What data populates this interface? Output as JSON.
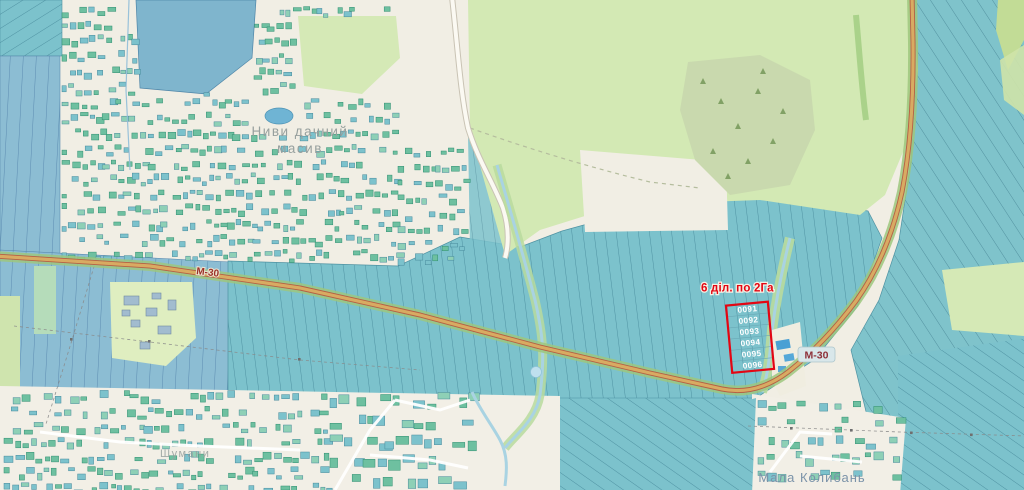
{
  "map": {
    "place_labels": {
      "massif_line1": "Ниви дачний",
      "massif_line2": "масив",
      "village_sw": "Шумани",
      "village_se": "Мала Колибань"
    },
    "road_labels": {
      "west": "М-30",
      "east": "М-30"
    },
    "annotation": {
      "title": "6 діл. по 2Га",
      "parcel_numbers": [
        "0091",
        "0092",
        "0093",
        "0094",
        "0095",
        "0096"
      ]
    },
    "colors": {
      "annotation_red": "#e30613",
      "parcel_teal": "#7cc2cc",
      "parcel_outline": "#4f92a2",
      "field_green": "#d3e9b4",
      "road_tan": "#d8ab62",
      "stream_blue": "#a9d3e2",
      "background": "#f1eee4"
    }
  }
}
